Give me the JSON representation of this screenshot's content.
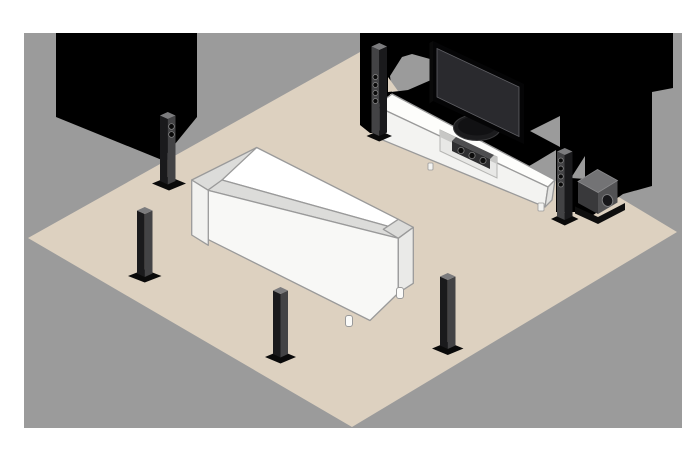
{
  "illustration": {
    "kind": "isometric-home-theater-speaker-placement",
    "objects": [
      "room-floor",
      "backdrop-wall",
      "shadow-shape-left",
      "shadow-shape-right",
      "sofa",
      "tv-bench",
      "flat-screen-tv",
      "tv-oval-stand",
      "center-speaker-bar",
      "tower-speaker-rear-left",
      "tower-speaker-side-left",
      "tower-speaker-back-center",
      "tower-speaker-back-right",
      "tower-speaker-front-left",
      "tower-speaker-front-right",
      "subwoofer"
    ],
    "tower_speaker_count": 6,
    "colors": {
      "page": "#ffffff",
      "backdrop": "#9b9b9b",
      "floor": "#ddd1c0",
      "silhouette": "#000000",
      "outline": "#9a9a9a",
      "furniture_white": "#f8f8f6",
      "furniture_top": "#dcdcda",
      "speaker_dark": "#1a1a1c",
      "speaker_light_face": "#434345",
      "speaker_cap": "#7c7c7e",
      "sub_top": "#737375",
      "sub_left": "#39393b",
      "sub_right": "#525254",
      "tv_bezel": "#050506",
      "tv_screen": "#2a2a2e"
    }
  }
}
